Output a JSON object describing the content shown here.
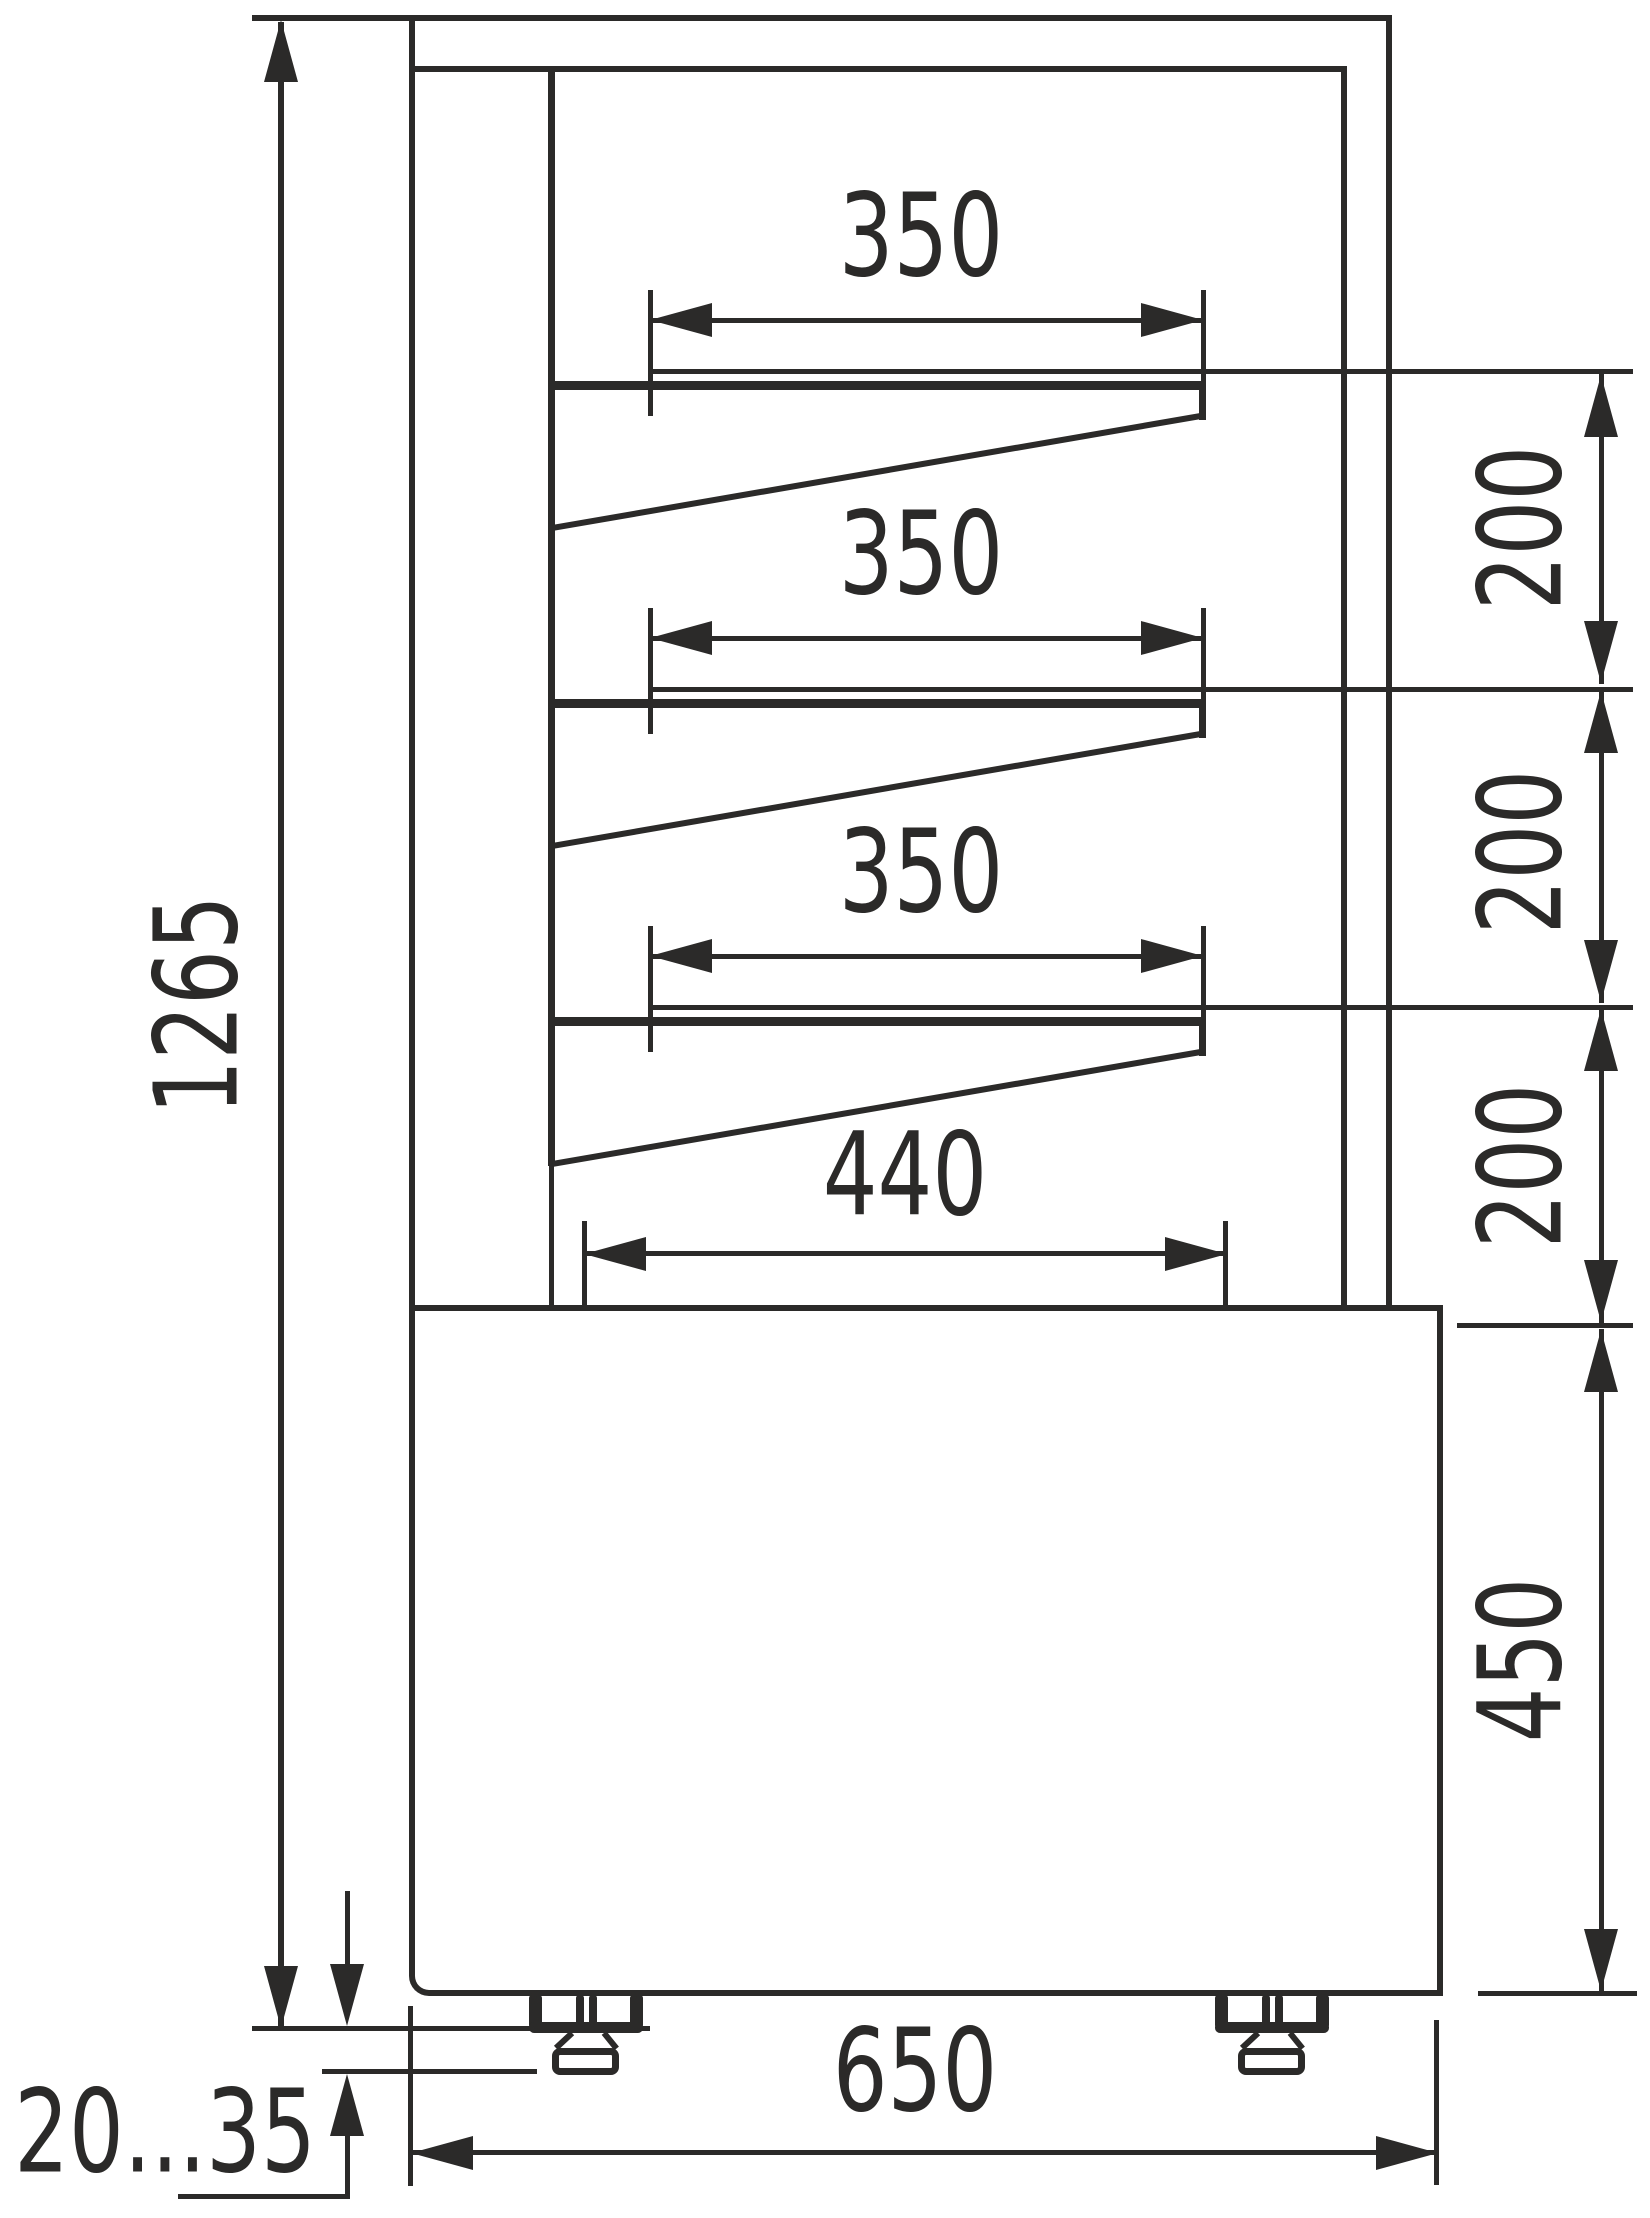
{
  "drawing": {
    "type": "technical-dimension-drawing",
    "subject": "display case side cross-section with three tilted shelves and adjustable feet",
    "ink_color": "#2b2a29",
    "background_color": "#ffffff",
    "dimensions": {
      "overall_height": "1265",
      "shelf_width_top": "350",
      "shelf_width_middle": "350",
      "shelf_width_bottom": "350",
      "shelf_gap_top": "200",
      "shelf_gap_middle": "200",
      "shelf_gap_bottom": "200",
      "bottom_compartment_width": "440",
      "base_height": "450",
      "overall_depth": "650",
      "foot_height_range": "20...35"
    }
  }
}
